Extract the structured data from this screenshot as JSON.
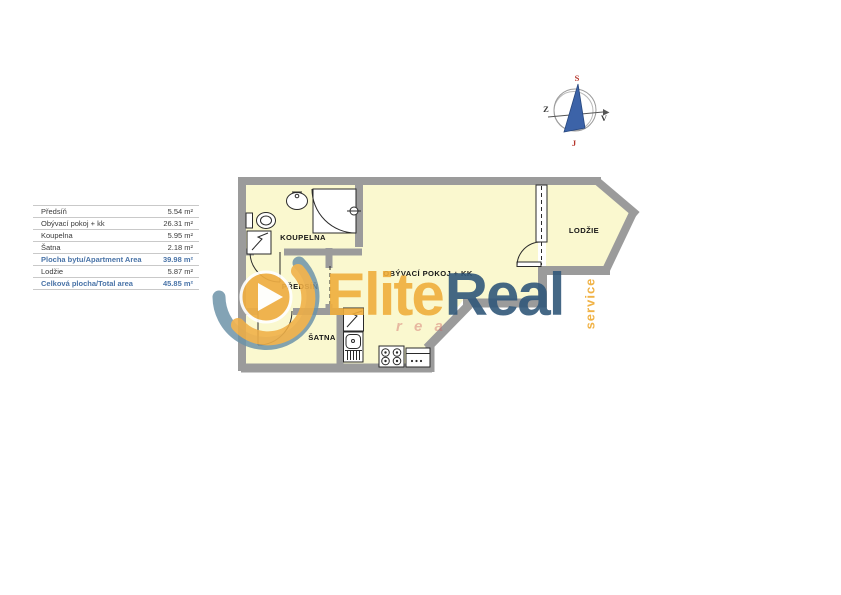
{
  "table": {
    "rows": [
      {
        "label": "Předsíň",
        "value": "5.54 m²"
      },
      {
        "label": "Obývací pokoj + kk",
        "value": "26.31 m²"
      },
      {
        "label": "Koupelna",
        "value": "5.95 m²"
      },
      {
        "label": "Šatna",
        "value": "2.18 m²"
      },
      {
        "label": "Plocha bytu/Apartment Area",
        "value": "39.98 m²"
      },
      {
        "label": "Lodžie",
        "value": "5.87 m²"
      },
      {
        "label": "Celková plocha/Total area",
        "value": "45.85 m²"
      }
    ]
  },
  "floorplan": {
    "rooms": [
      {
        "name": "KOUPELNA"
      },
      {
        "name": "PŘEDSÍŇ"
      },
      {
        "name": "ŠATNA"
      },
      {
        "name": "OBÝVACÍ POKOJ + KK"
      },
      {
        "name": "LODŽIE"
      }
    ]
  },
  "compass": {
    "north": "S",
    "south": "J",
    "west": "Z",
    "east": "V"
  },
  "watermark": {
    "brand_first": "Elite",
    "brand_second": "Real",
    "vertical_text": "service",
    "faint_text": "r e a"
  },
  "colors": {
    "floor": "#FAF8CF",
    "wall": "#9B9B9B",
    "brand-orange": "#F0AE3C",
    "brand-blue": "#31587A",
    "table-highlight": "#4A74A8",
    "compass-red": "#B5342A",
    "needle-blue": "#3C63A8"
  }
}
